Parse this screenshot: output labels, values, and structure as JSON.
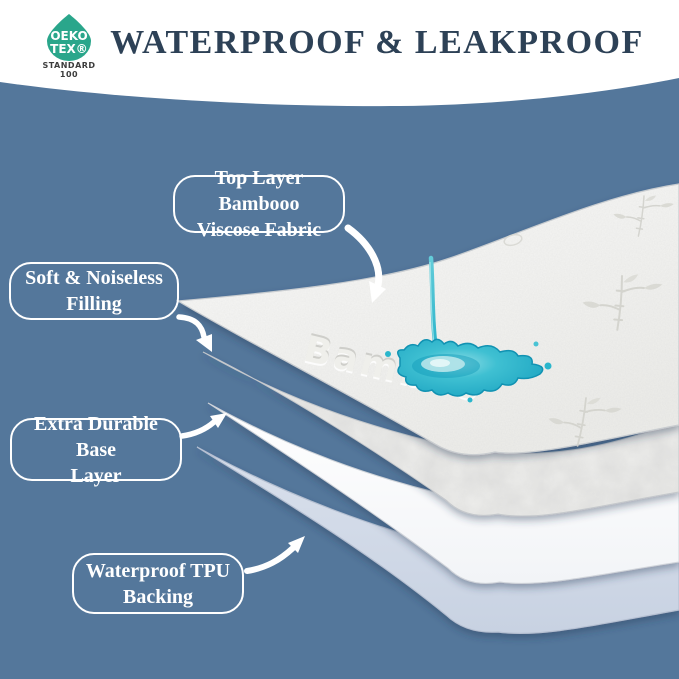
{
  "theme": {
    "bg": "#54779b",
    "banner": "#ffffff",
    "title": "#2d4156",
    "label": "#ffffff",
    "logo-teal": "#2aa68b",
    "water": "#29b3ca",
    "tpu": "#d9e0ec",
    "fabric": "#f3f3f0"
  },
  "header": {
    "title": "WATERPROOF & LEAKPROOF",
    "logo": {
      "line1": "OEKO",
      "line2": "TEX®",
      "standard": "STANDARD",
      "number": "100"
    }
  },
  "callouts": [
    {
      "line1": "Top Layer Bambooo",
      "line2": "Viscose Fabric"
    },
    {
      "line1": "Soft & Noiseless",
      "line2": "Filling"
    },
    {
      "line1": "Extra Durable Base",
      "line2": "Layer"
    },
    {
      "line1": "Waterproof TPU",
      "line2": "Backing"
    }
  ],
  "illustration": {
    "fabric_text": "Bamboo",
    "layers": [
      "Top bamboo viscose fabric",
      "Soft noiseless filling",
      "Extra durable base layer",
      "Waterproof TPU backing"
    ]
  }
}
